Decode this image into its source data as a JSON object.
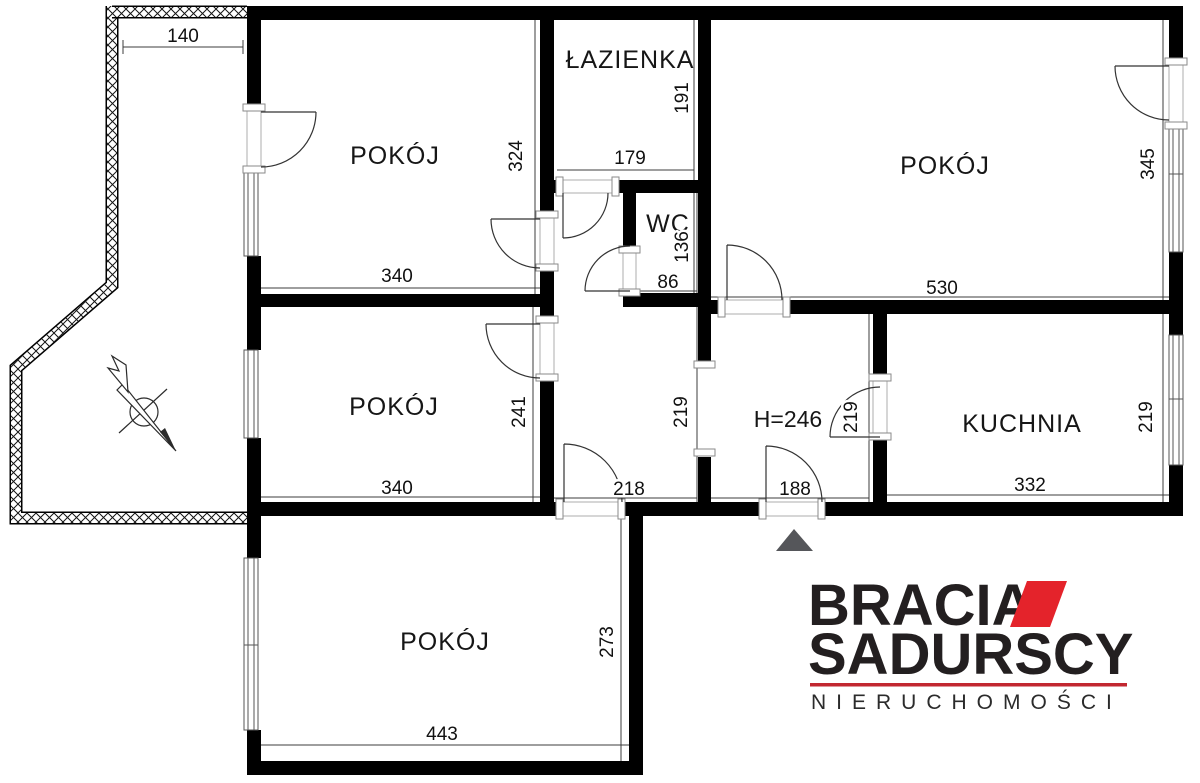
{
  "plan": {
    "rooms": {
      "top_left": "POKÓJ",
      "top_right": "POKÓJ",
      "middle_left": "POKÓJ",
      "bottom": "POKÓJ",
      "bathroom": "ŁAZIENKA",
      "wc": "WC",
      "kitchen": "KUCHNIA"
    },
    "ceiling_height": "H=246",
    "dims": {
      "balcony_top": "140",
      "tl_h": "324",
      "tl_w": "340",
      "bath_w": "179",
      "bath_h": "191",
      "wc_w": "86",
      "wc_h": "136",
      "tr_w": "530",
      "tr_h": "345",
      "ml_w": "340",
      "ml_h": "241",
      "hall_l": "219",
      "hall_r": "219",
      "hall_w": "218",
      "entry_w": "188",
      "kit_w": "332",
      "kit_h": "219",
      "b_w": "443",
      "b_h": "273"
    }
  },
  "logo": {
    "line1": "BRACIA",
    "line2": "SADURSCY",
    "tagline": "NIERUCHOMOŚCI"
  },
  "colors": {
    "wall": "#000000",
    "logo_black": "#231f20",
    "logo_red": "#e4232b",
    "rule_red": "#c22730",
    "entry_marker": "#55565a",
    "background": "#ffffff"
  }
}
